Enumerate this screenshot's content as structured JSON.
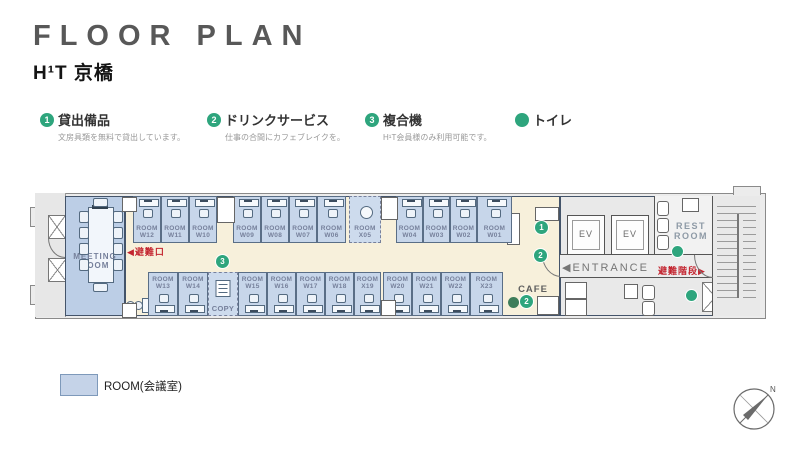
{
  "header": {
    "title": "FLOOR PLAN",
    "subtitle": "H¹T 京橋"
  },
  "legend": {
    "items": [
      {
        "num": "1",
        "label": "貸出備品",
        "caption": "文房具類を無料で貸出しています。"
      },
      {
        "num": "2",
        "label": "ドリンクサービス",
        "caption": "仕事の合間にカフェブレイクを。"
      },
      {
        "num": "3",
        "label": "複合機",
        "caption": "H¹T会員様のみ利用可能です。"
      },
      {
        "num": "",
        "label": "トイレ",
        "caption": ""
      }
    ]
  },
  "plan": {
    "room_word": "ROOM",
    "meeting_room": "MEETING ROOM",
    "exit": "◀避難口",
    "entrance": "◀ENTRANCE",
    "stairs": "避難階段▶",
    "restroom": "REST ROOM",
    "ev": "EV",
    "cafe": "CAFE",
    "copy": "COPY",
    "top_rooms": [
      "W12",
      "W11",
      "W10",
      "W09",
      "W08",
      "W07",
      "W06",
      "X05",
      "W04",
      "W03",
      "W02",
      "W01"
    ],
    "bottom_rooms": [
      "W13",
      "W14",
      "W15",
      "W16",
      "W17",
      "W18",
      "X19",
      "W20",
      "W21",
      "W22",
      "X23"
    ],
    "markers": [
      {
        "id": "lending",
        "num": "1"
      },
      {
        "id": "drink-entrance",
        "num": "2"
      },
      {
        "id": "drink-cafe",
        "num": "2"
      },
      {
        "id": "copier",
        "num": "3"
      }
    ],
    "toilet_dots": 2
  },
  "map_legend": {
    "label": "ROOM(会議室)"
  },
  "compass": {
    "north": "N"
  },
  "colors": {
    "green": "#2ea57d",
    "red": "#c32530",
    "room_blue": "#c7d6ea",
    "corridor": "#f7f0db"
  }
}
